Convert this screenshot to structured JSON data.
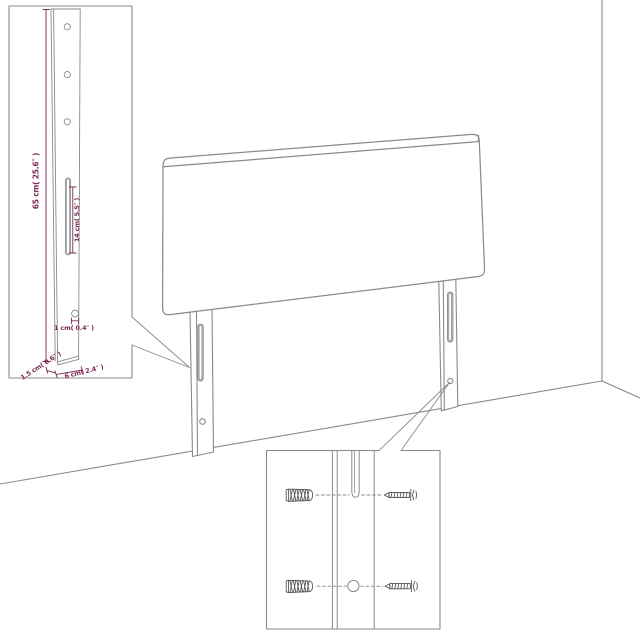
{
  "labels": {
    "leg_height": "65 cm( 25.6″ )",
    "slot_length": "14 cm( 5.5″ )",
    "hole_diameter": "1 cm( 0.4″ )",
    "leg_depth": "1.5 cm( 0.6″ )",
    "leg_width": "6 cm( 2.4″ )"
  },
  "colors": {
    "outline": "#8a8a8a",
    "dimension": "#7b2a56",
    "hardware": "#4f4f4f",
    "background": "#ffffff"
  }
}
